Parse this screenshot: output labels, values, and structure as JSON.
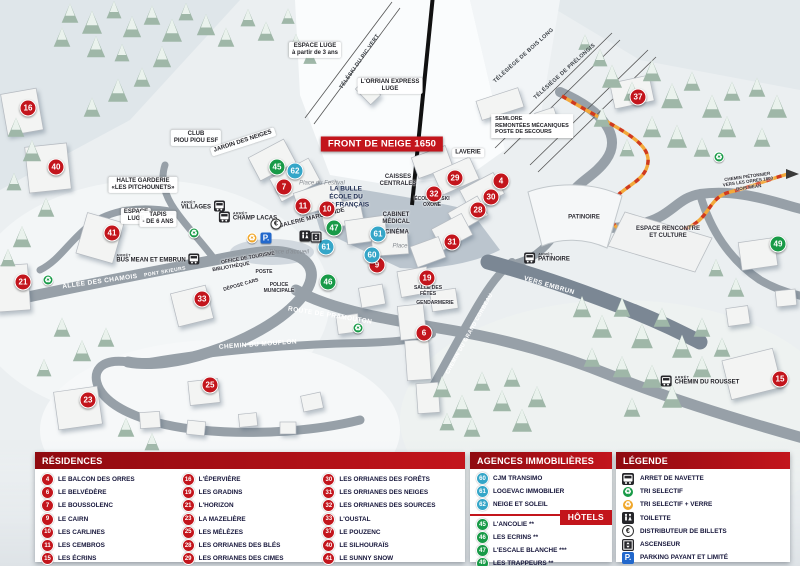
{
  "map": {
    "banner": "FRONT DE NEIGE 1650",
    "stop_prefix": "ARRÊT",
    "markers": [
      {
        "num": "16",
        "color": "red",
        "x": 28,
        "y": 108
      },
      {
        "num": "40",
        "color": "red",
        "x": 56,
        "y": 167
      },
      {
        "num": "41",
        "color": "red",
        "x": 112,
        "y": 233
      },
      {
        "num": "21",
        "color": "red",
        "x": 23,
        "y": 282
      },
      {
        "num": "33",
        "color": "red",
        "x": 202,
        "y": 299
      },
      {
        "num": "23",
        "color": "red",
        "x": 88,
        "y": 400
      },
      {
        "num": "25",
        "color": "red",
        "x": 210,
        "y": 385
      },
      {
        "num": "7",
        "color": "red",
        "x": 284,
        "y": 187
      },
      {
        "num": "11",
        "color": "red",
        "x": 303,
        "y": 206
      },
      {
        "num": "10",
        "color": "red",
        "x": 327,
        "y": 209
      },
      {
        "num": "9",
        "color": "red",
        "x": 377,
        "y": 265
      },
      {
        "num": "19",
        "color": "red",
        "x": 427,
        "y": 278
      },
      {
        "num": "6",
        "color": "red",
        "x": 424,
        "y": 333
      },
      {
        "num": "29",
        "color": "red",
        "x": 455,
        "y": 178
      },
      {
        "num": "32",
        "color": "red",
        "x": 434,
        "y": 194
      },
      {
        "num": "31",
        "color": "red",
        "x": 452,
        "y": 242
      },
      {
        "num": "28",
        "color": "red",
        "x": 478,
        "y": 210
      },
      {
        "num": "30",
        "color": "red",
        "x": 491,
        "y": 197
      },
      {
        "num": "4",
        "color": "red",
        "x": 501,
        "y": 181
      },
      {
        "num": "37",
        "color": "red",
        "x": 638,
        "y": 97
      },
      {
        "num": "15",
        "color": "red",
        "x": 780,
        "y": 379
      },
      {
        "num": "45",
        "color": "green",
        "x": 277,
        "y": 167
      },
      {
        "num": "47",
        "color": "green",
        "x": 334,
        "y": 228
      },
      {
        "num": "46",
        "color": "green",
        "x": 328,
        "y": 282
      },
      {
        "num": "49",
        "color": "green",
        "x": 778,
        "y": 244
      },
      {
        "num": "62",
        "color": "blue",
        "x": 295,
        "y": 171
      },
      {
        "num": "61",
        "color": "blue",
        "x": 326,
        "y": 247
      },
      {
        "num": "61",
        "color": "blue",
        "x": 378,
        "y": 234
      },
      {
        "num": "60",
        "color": "blue",
        "x": 372,
        "y": 255
      }
    ],
    "labels": [
      {
        "t": "ESPACE LUGE\nà partir de 3 ans",
        "x": 315,
        "y": 50,
        "c": "pill"
      },
      {
        "t": "L'ORRIAN EXPRESS\nLUGE",
        "x": 390,
        "y": 86,
        "c": "pill"
      },
      {
        "t": "TÉLÉSKI DU PIC VERT",
        "x": 360,
        "y": 62,
        "c": "lift",
        "r": -55
      },
      {
        "t": "TÉLÉSIÈGE DE BOIS LONG",
        "x": 524,
        "y": 56,
        "c": "lift",
        "r": -42
      },
      {
        "t": "TÉLÉSIÈGE DE PRÉLONGIS",
        "x": 565,
        "y": 72,
        "c": "lift",
        "r": -42
      },
      {
        "t": "SEMLORE\nREMONTÉES MÉCANIQUES\nPOSTE DE SECOURS",
        "x": 532,
        "y": 126,
        "c": "box"
      },
      {
        "t": "CLUB\nPIOU PIOU ESF",
        "x": 196,
        "y": 138,
        "c": "pill"
      },
      {
        "t": "JARDIN DES NEIGES",
        "x": 243,
        "y": 142,
        "c": "pill",
        "r": -18
      },
      {
        "t": "HALTE GARDERIE\n«LES PITCHOUNETS»",
        "x": 143,
        "y": 185,
        "c": "pill"
      },
      {
        "t": "ESPACE\nLUGE",
        "x": 136,
        "y": 216,
        "c": "pill"
      },
      {
        "t": "TAPIS\n- DE 6 ANS",
        "x": 158,
        "y": 219,
        "c": "pill"
      },
      {
        "t": "LAVERIE",
        "x": 468,
        "y": 153,
        "c": "pill"
      },
      {
        "t": "CAISSES\nCENTRALES",
        "x": 398,
        "y": 181,
        "c": "dark"
      },
      {
        "t": "Place du Festival",
        "x": 322,
        "y": 184,
        "c": "place"
      },
      {
        "t": "LA BULLE\nÉCOLE DU\nSKI FRANÇAIS",
        "x": 346,
        "y": 197,
        "c": "navy"
      },
      {
        "t": "ÉCOLE DE SKI\nOXONE",
        "x": 432,
        "y": 202,
        "c": "dark",
        "fs": 5
      },
      {
        "t": "GALERIE MARCHANDE",
        "x": 312,
        "y": 219,
        "c": "dark",
        "r": -14
      },
      {
        "t": "CABINET\nMÉDICAL",
        "x": 396,
        "y": 219,
        "c": "dark"
      },
      {
        "t": "CINÉMA",
        "x": 397,
        "y": 233,
        "c": "dark"
      },
      {
        "t": "Place",
        "x": 400,
        "y": 247,
        "c": "place"
      },
      {
        "t": "OFFICE DE TOURISME",
        "x": 248,
        "y": 258,
        "c": "dark",
        "r": -10,
        "fs": 5
      },
      {
        "t": "Place d'accueil",
        "x": 289,
        "y": 253,
        "c": "place"
      },
      {
        "t": "BIBLIOTHÈQUE",
        "x": 231,
        "y": 267,
        "c": "dark",
        "r": -10,
        "fs": 5
      },
      {
        "t": "POSTE",
        "x": 264,
        "y": 272,
        "c": "dark",
        "fs": 5
      },
      {
        "t": "DÉPOSE CARS",
        "x": 241,
        "y": 285,
        "c": "dark",
        "r": -16,
        "fs": 5
      },
      {
        "t": "POLICE\nMUNICIPALE",
        "x": 279,
        "y": 288,
        "c": "dark",
        "fs": 5
      },
      {
        "t": "SALLE DES\nFÊTES",
        "x": 428,
        "y": 291,
        "c": "dark",
        "fs": 5
      },
      {
        "t": "GENDARMERIE",
        "x": 435,
        "y": 303,
        "c": "dark",
        "fs": 5
      },
      {
        "t": "PATINOIRE",
        "x": 584,
        "y": 218,
        "c": "dark"
      },
      {
        "t": "ESPACE RENCONTRE\nET CULTURE",
        "x": 668,
        "y": 233,
        "c": "dark"
      },
      {
        "t": "CHEMIN PIÉTONNIER\nVERS LES ORRES 1800\nBOIS MÉAN",
        "x": 748,
        "y": 182,
        "c": "dark",
        "fs": 4.5,
        "r": -8
      },
      {
        "t": "ALLÉE DES CHAMOIS",
        "x": 100,
        "y": 282,
        "c": "road",
        "r": -8
      },
      {
        "t": "PONT SKIEURS",
        "x": 165,
        "y": 272,
        "c": "road",
        "fs": 5,
        "r": -10
      },
      {
        "t": "ROUTE DE PRAMOUTON",
        "x": 330,
        "y": 316,
        "c": "road",
        "r": 9
      },
      {
        "t": "CHEMIN DU MOUFLON",
        "x": 258,
        "y": 345,
        "c": "road",
        "r": -4
      },
      {
        "t": "CHEMIN DU GRAND CORBEAU",
        "x": 470,
        "y": 334,
        "c": "road",
        "r": -61,
        "fs": 5.5
      },
      {
        "t": "VERS EMBRUN",
        "x": 549,
        "y": 286,
        "c": "road",
        "r": 16
      }
    ],
    "stops": [
      {
        "name": "VILLAGES",
        "x": 203,
        "y": 206,
        "side": "right"
      },
      {
        "name": "CHAMP LACAS",
        "x": 248,
        "y": 217,
        "side": "left"
      },
      {
        "name": "BUS MEAN ET EMBRUN",
        "x": 158,
        "y": 259,
        "side": "right"
      },
      {
        "name": "PATINOIRE",
        "x": 547,
        "y": 258,
        "side": "left"
      },
      {
        "name": "CHEMIN DU ROUSSET",
        "x": 700,
        "y": 381,
        "side": "left"
      }
    ],
    "icons": [
      {
        "k": "recycle-green",
        "x": 48,
        "y": 280
      },
      {
        "k": "recycle-green",
        "x": 194,
        "y": 233
      },
      {
        "k": "recycle-green",
        "x": 358,
        "y": 328
      },
      {
        "k": "recycle-green",
        "x": 719,
        "y": 157
      },
      {
        "k": "recycle-yellow",
        "x": 252,
        "y": 238
      },
      {
        "k": "parking",
        "x": 266,
        "y": 238
      },
      {
        "k": "euro",
        "x": 276,
        "y": 224
      },
      {
        "k": "wc",
        "x": 305,
        "y": 236
      },
      {
        "k": "elevator",
        "x": 316,
        "y": 237
      }
    ]
  },
  "colors": {
    "marker_red": "#c3151c",
    "marker_green": "#189a47",
    "marker_blue": "#35a6c8",
    "parking_blue": "#2268cc",
    "recycle_yellow": "#f0a72b",
    "header_red": "#c3151c",
    "path_orange": "#f3a83a"
  },
  "panels": {
    "residences": {
      "title": "RÉSIDENCES",
      "columns": [
        [
          {
            "num": "4",
            "label": "LE BALCON DES ORRES"
          },
          {
            "num": "6",
            "label": "LE BELVÉDÈRE"
          },
          {
            "num": "7",
            "label": "LE BOUSSOLENC"
          },
          {
            "num": "9",
            "label": "LE CAIRN"
          },
          {
            "num": "10",
            "label": "LES CARLINES"
          },
          {
            "num": "11",
            "label": "LES CEMBROS"
          },
          {
            "num": "15",
            "label": "LES ÉCRINS"
          }
        ],
        [
          {
            "num": "16",
            "label": "L'ÉPERVIÈRE"
          },
          {
            "num": "19",
            "label": "LES GRADINS"
          },
          {
            "num": "21",
            "label": "L'HORIZON"
          },
          {
            "num": "23",
            "label": "LA MAZELIÈRE"
          },
          {
            "num": "25",
            "label": "LES MÉLÈZES"
          },
          {
            "num": "28",
            "label": "LES ORRIANES DES BLÉS"
          },
          {
            "num": "29",
            "label": "LES ORRIANES DES CIMES"
          }
        ],
        [
          {
            "num": "30",
            "label": "LES ORRIANES DES FORÊTS"
          },
          {
            "num": "31",
            "label": "LES ORRIANES DES NEIGES"
          },
          {
            "num": "32",
            "label": "LES ORRIANES DES SOURCES"
          },
          {
            "num": "33",
            "label": "L'OUSTAL"
          },
          {
            "num": "37",
            "label": "LE POUZENC"
          },
          {
            "num": "40",
            "label": "LE SILHOURAÏS"
          },
          {
            "num": "41",
            "label": "LE SUNNY SNOW"
          }
        ]
      ]
    },
    "agences": {
      "title": "AGENCES IMMOBILIÈRES",
      "items": [
        {
          "num": "60",
          "label": "CJM TRANSIMO"
        },
        {
          "num": "61",
          "label": "LOGEVAC IMMOBILIER"
        },
        {
          "num": "62",
          "label": "NEIGE ET SOLEIL"
        }
      ]
    },
    "hotels": {
      "title": "HÔTELS",
      "items": [
        {
          "num": "45",
          "label": "L'ANCOLIE **"
        },
        {
          "num": "46",
          "label": "LES ECRINS **"
        },
        {
          "num": "47",
          "label": "L'ESCALE BLANCHE ***"
        },
        {
          "num": "49",
          "label": "LES TRAPPEURS **"
        }
      ]
    },
    "legende": {
      "title": "LÉGENDE",
      "items": [
        {
          "icon": "bus",
          "label": "ARRET DE NAVETTE"
        },
        {
          "icon": "recycle-green",
          "label": "TRI SELECTIF"
        },
        {
          "icon": "recycle-yellow",
          "label": "TRI SELECTIF + VERRE"
        },
        {
          "icon": "wc",
          "label": "TOILETTE"
        },
        {
          "icon": "euro",
          "label": "DISTRIBUTEUR DE BILLETS"
        },
        {
          "icon": "elevator",
          "label": "ASCENSEUR"
        },
        {
          "icon": "parking",
          "label": "PARKING PAYANT ET LIMITÉ"
        }
      ]
    }
  }
}
